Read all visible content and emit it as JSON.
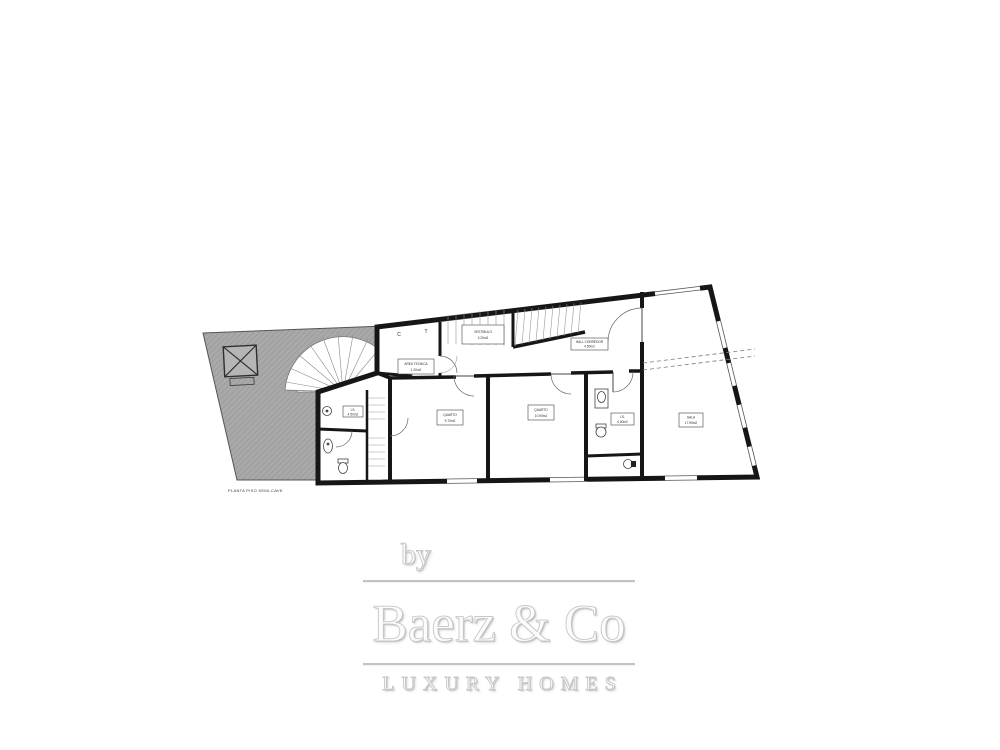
{
  "floor_plan": {
    "caption": "PLANTA PISO SEMI-CAVE",
    "wall_marks": {
      "c": "C",
      "t": "T"
    },
    "colors": {
      "wall": "#161616",
      "detail_line": "#8a8a8a",
      "terrace_fill": "#a9a9a9",
      "background": "#ffffff"
    },
    "rooms": [
      {
        "name": "I.S.",
        "area": "4.50m2"
      },
      {
        "name": "QUARTO",
        "area": "9.70m2"
      },
      {
        "name": "QUARTO",
        "area": "10.90m2"
      },
      {
        "name": "I.S.",
        "area": "4.00m2"
      },
      {
        "name": "SALA",
        "area": "17.90m2"
      },
      {
        "name": "HALL CORREDOR",
        "area": "4.50m2"
      },
      {
        "name": "VESTIBULO",
        "area": "3.20m2"
      },
      {
        "name": "AREA TECNICA",
        "area": "1.20m2"
      }
    ]
  },
  "branding": {
    "prefix": "by",
    "name": "Baerz & Co",
    "tagline": "LUXURY HOMES",
    "text_color": "#fcfcfc",
    "stroke_color": "#c7c7c7",
    "line_color": "#c3c3c3"
  }
}
